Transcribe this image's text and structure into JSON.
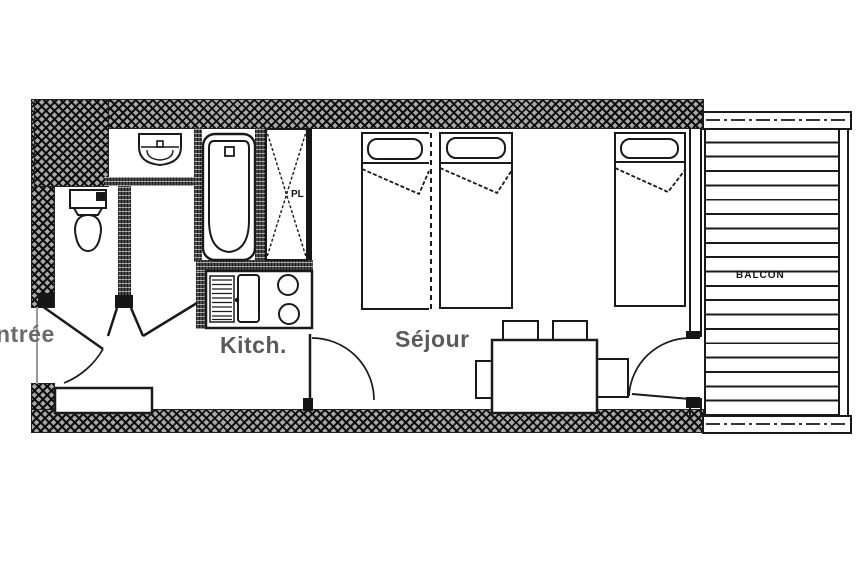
{
  "title": "Studio apartment floor plan",
  "labels": {
    "entrance": "ntrée",
    "kitchen": "Kitch.",
    "living": "Séjour",
    "closet": "PL",
    "balcony": "BALCON"
  },
  "colors": {
    "ink": "#1a1a1a",
    "label_gray": "#5a5a5a",
    "wall_texture": "#a8a8a8",
    "background": "#ffffff"
  },
  "inventory": {
    "beds": 3,
    "dining_chairs": 4,
    "stove_burners": 2,
    "balcony_slats": 20,
    "fixtures": [
      "toilet",
      "washbasin",
      "bathtub",
      "wardrobe-closet",
      "kitchen-sink",
      "drainer",
      "dining-table",
      "balcony-deck"
    ]
  }
}
